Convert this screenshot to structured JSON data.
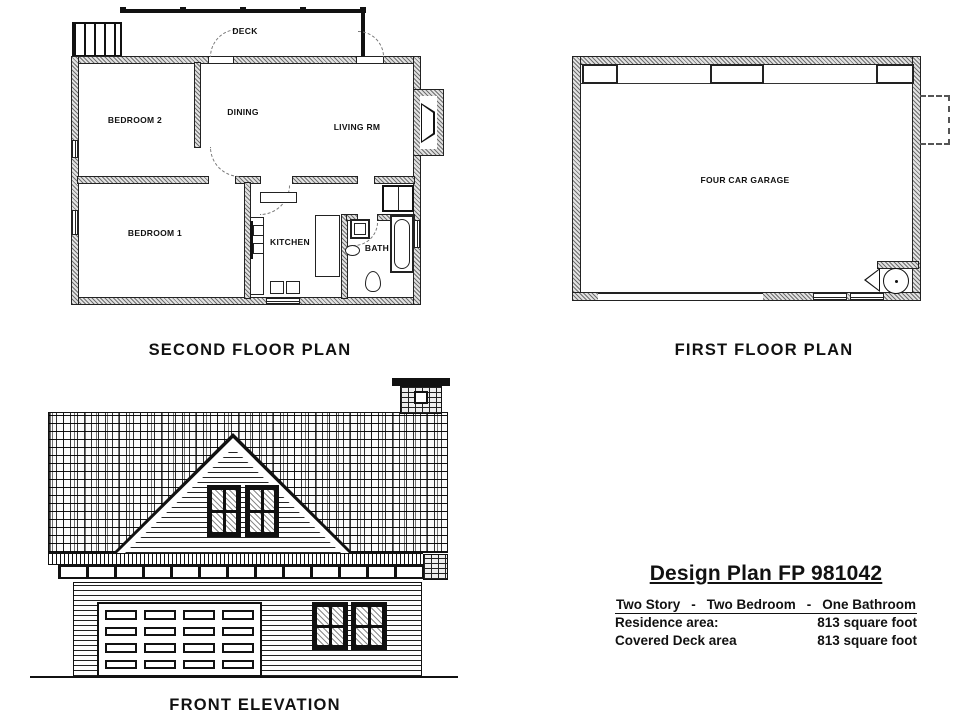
{
  "plans": {
    "second_floor": {
      "label": "SECOND FLOOR PLAN",
      "rooms": {
        "deck": "DECK",
        "bedroom2": "BEDROOM 2",
        "dining": "DINING",
        "living": "LIVING RM",
        "bedroom1": "BEDROOM 1",
        "kitchen": "KITCHEN",
        "bath": "BATH"
      }
    },
    "first_floor": {
      "label": "FIRST FLOOR PLAN",
      "rooms": {
        "garage": "FOUR CAR GARAGE"
      }
    },
    "front_elevation": {
      "label": "FRONT ELEVATION"
    }
  },
  "title_block": {
    "title": "Design Plan FP 981042",
    "spec_items": [
      "Two Story",
      "Two Bedroom",
      "One Bathroom"
    ],
    "spec_separator": "-",
    "rows": [
      {
        "label": "Residence area:",
        "value": "813 square foot"
      },
      {
        "label": "Covered Deck area",
        "value": "813 square foot"
      }
    ]
  },
  "colors": {
    "ink": "#111111",
    "wall_gray": "#8f8f8f",
    "paper": "#ffffff"
  }
}
